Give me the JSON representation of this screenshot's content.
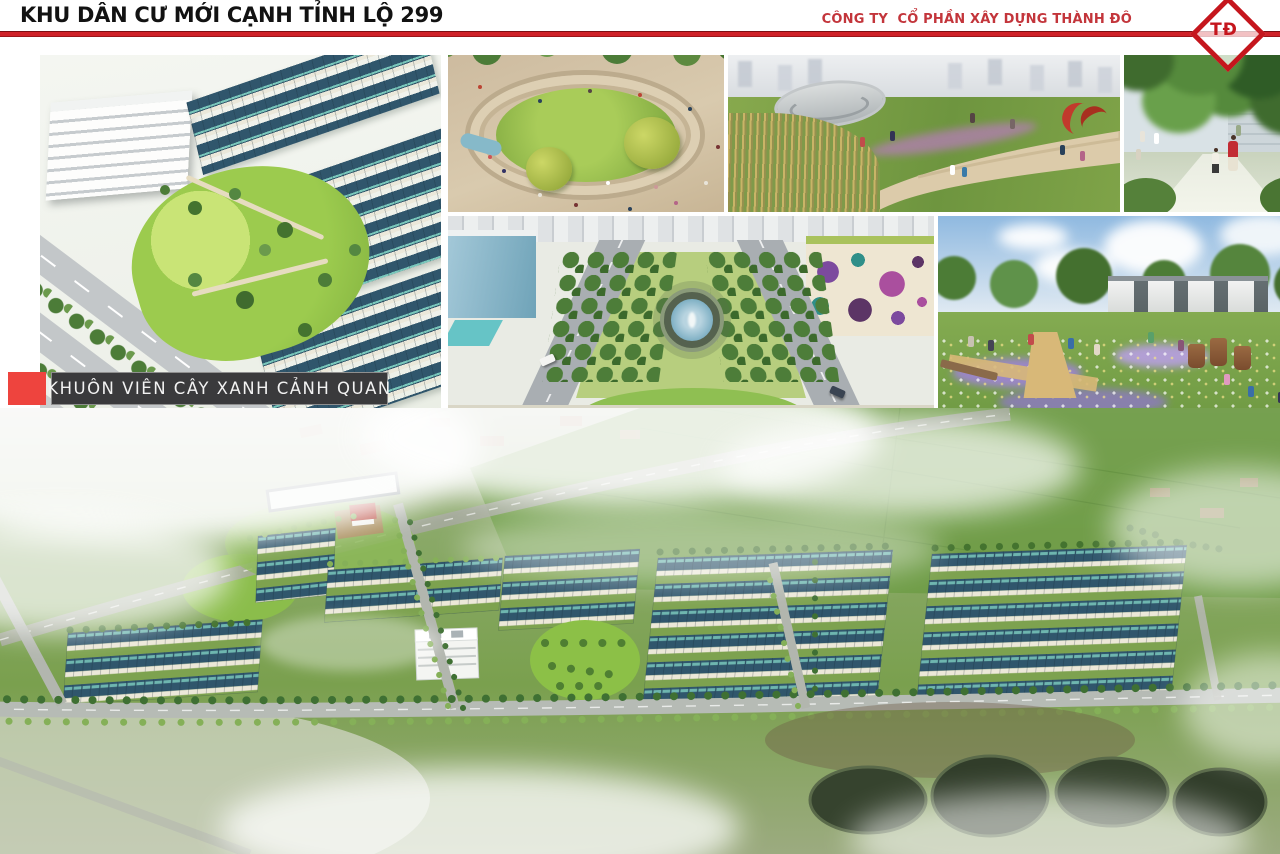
{
  "header": {
    "title": "KHU DÂN CƯ MỚI CẠNH TỈNH LỘ 299",
    "company": "CÔNG TY  CỔ PHẦN XÂY DỰNG THÀNH ĐÔ",
    "logo_text": "TĐ"
  },
  "caption": {
    "label": "KHUÔN VIÊN CÂY XANH CẢNH QUAN"
  },
  "colors": {
    "accent_red": "#c5161d",
    "divider_red": "#cf2128",
    "company_red": "#c3353b",
    "caption_square_red": "#ee443e",
    "caption_bar_bg": "#3a3a3c",
    "caption_text": "#f2f2f2",
    "roof_teal": "#30566c",
    "roof_skylight_teal": "#79c7bb",
    "lawn_green": "#8cc047",
    "field_green": "#6f9c46",
    "road_gray": "#b6bbb5",
    "pond_dark": "#36432e",
    "sky_blue": "#8fb9e0"
  }
}
